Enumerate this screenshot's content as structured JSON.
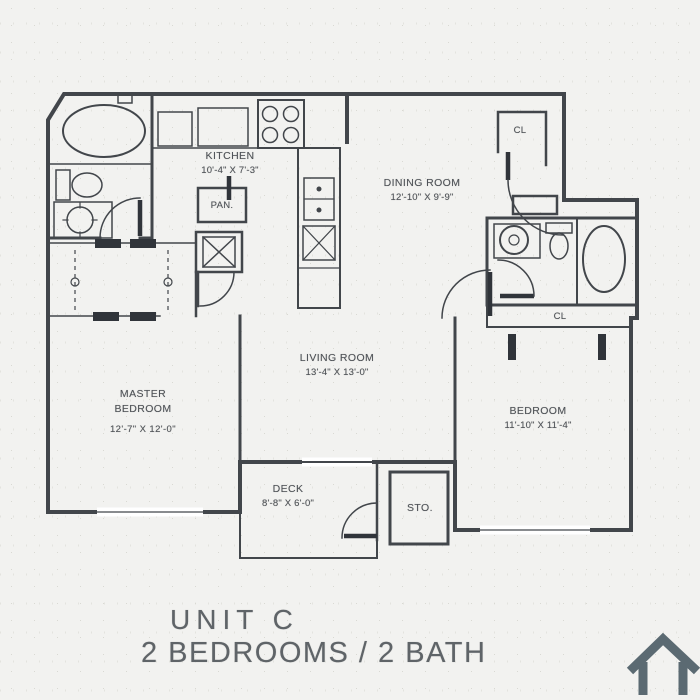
{
  "colors": {
    "line": "#42464b",
    "dark": "#30343a",
    "text": "#4e5257",
    "footer_text": "#5f6468",
    "house_icon": "#5b6a72",
    "background": "#f2f2f0"
  },
  "rooms": {
    "kitchen": {
      "name": "KITCHEN",
      "dims": "10'-4\" X 7'-3\""
    },
    "dining": {
      "name": "DINING ROOM",
      "dims": "12'-10\" X 9'-9\""
    },
    "living": {
      "name": "LIVING ROOM",
      "dims": "13'-4\" X 13'-0\""
    },
    "master": {
      "name": "MASTER BEDROOM",
      "dims": "12'-7\" X 12'-0\""
    },
    "bedroom": {
      "name": "BEDROOM",
      "dims": "11'-10\" X 11'-4\""
    },
    "deck": {
      "name": "DECK",
      "dims": "8'-8\" X 6'-0\""
    }
  },
  "labels": {
    "pantry": "PAN.",
    "storage": "STO.",
    "closet_entry": "CL",
    "closet_bedroom": "CL"
  },
  "footer": {
    "unit": "UNIT C",
    "description": "2 BEDROOMS / 2 BATH"
  }
}
